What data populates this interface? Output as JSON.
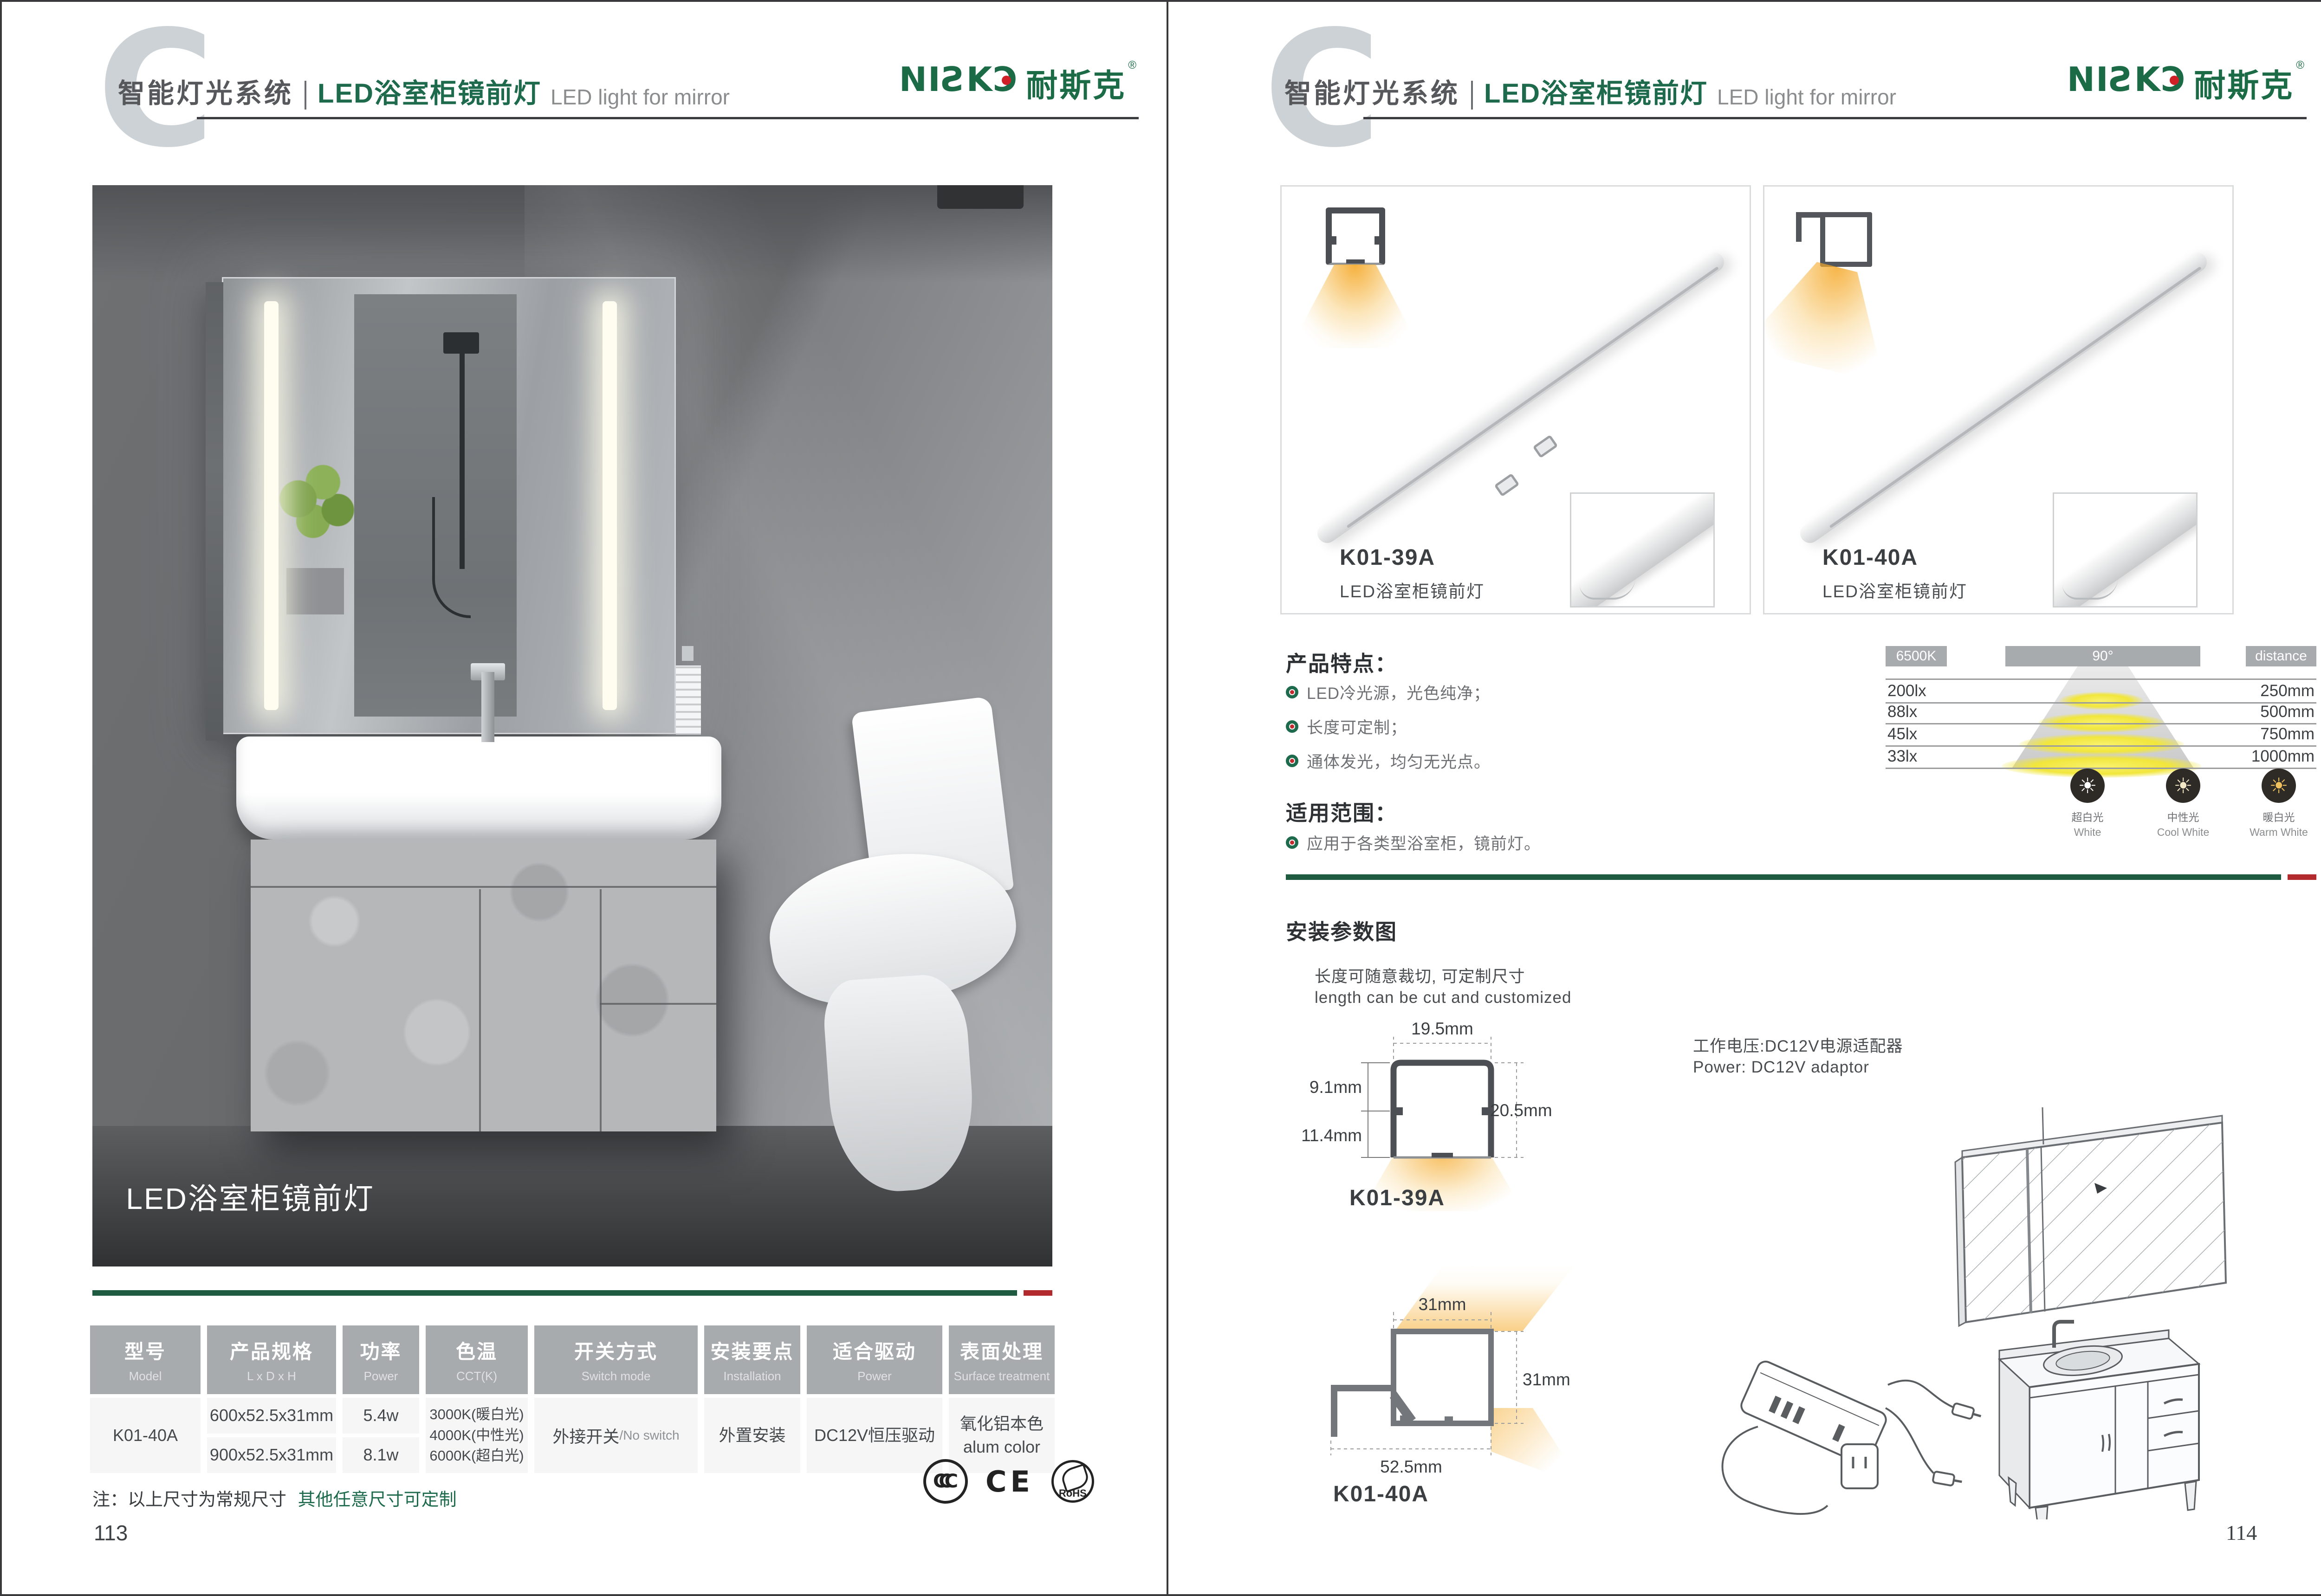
{
  "brand": {
    "latin": "NIƧKƆ",
    "cjk": "耐斯克",
    "reg": "®"
  },
  "header": {
    "watermark": "C",
    "section_zh": "智能灯光系统",
    "title_zh": "LED浴室柜镜前灯",
    "title_en": "LED light for mirror"
  },
  "left_page": {
    "photo_caption": "LED浴室柜镜前灯",
    "table": {
      "headers": [
        {
          "zh": "型号",
          "en": "Model"
        },
        {
          "zh": "产品规格",
          "en": "L x D x H"
        },
        {
          "zh": "功率",
          "en": "Power"
        },
        {
          "zh": "色温",
          "en": "CCT(K)"
        },
        {
          "zh": "开关方式",
          "en": "Switch mode"
        },
        {
          "zh": "安装要点",
          "en": "Installation"
        },
        {
          "zh": "适合驱动",
          "en": "Power"
        },
        {
          "zh": "表面处理",
          "en": "Surface treatment"
        }
      ],
      "model": "K01-40A",
      "specs": [
        "600x52.5x31mm",
        "900x52.5x31mm"
      ],
      "powers": [
        "5.4w",
        "8.1w"
      ],
      "cct": [
        "3000K(暖白光)",
        "4000K(中性光)",
        "6000K(超白光)"
      ],
      "switch_zh": "外接开关",
      "switch_en": "/No switch",
      "installation": "外置安装",
      "driver": "DC12V恒压驱动",
      "surface_zh": "氧化铝本色",
      "surface_en": "alum color"
    },
    "note_black": "注：以上尺寸为常规尺寸",
    "note_green": "其他任意尺寸可定制",
    "certs": {
      "ccc": "CCC",
      "ce": "CE",
      "rohs": "RoHS"
    },
    "page_number": "113"
  },
  "right_page": {
    "products": [
      {
        "model": "K01-39A",
        "name": "LED浴室柜镜前灯"
      },
      {
        "model": "K01-40A",
        "name": "LED浴室柜镜前灯"
      }
    ],
    "features": {
      "title": "产品特点：",
      "items": [
        "LED冷光源，光色纯净；",
        "长度可定制；",
        "通体发光，均匀无光点。"
      ]
    },
    "photometric": {
      "cct": "6500K",
      "angle": "90°",
      "distance_label": "distance",
      "rows": [
        {
          "lux": "200lx",
          "mm": "250mm"
        },
        {
          "lux": "88lx",
          "mm": "500mm"
        },
        {
          "lux": "45lx",
          "mm": "750mm"
        },
        {
          "lux": "33lx",
          "mm": "1000mm"
        }
      ]
    },
    "color_temps": [
      {
        "zh": "超白光",
        "en": "White"
      },
      {
        "zh": "中性光",
        "en": "Cool White"
      },
      {
        "zh": "暖白光",
        "en": "Warm White"
      }
    ],
    "scope": {
      "title": "适用范围：",
      "items": [
        "应用于各类型浴室柜，镜前灯。"
      ]
    },
    "install": {
      "title": "安装参数图",
      "cut_zh": "长度可随意裁切, 可定制尺寸",
      "cut_en": "length can be cut and customized",
      "power_zh": "工作电压:DC12V电源适配器",
      "power_en": "Power: DC12V adaptor",
      "k39": {
        "model": "K01-39A",
        "top": "19.5mm",
        "left_upper": "9.1mm",
        "left_lower": "11.4mm",
        "right": "20.5mm"
      },
      "k40": {
        "model": "K01-40A",
        "top": "31mm",
        "right": "31mm",
        "bottom": "52.5mm"
      }
    },
    "page_number": "114"
  },
  "icons": {
    "sun": "☀"
  },
  "colors": {
    "brand_green": "#1d6b4c",
    "divider_green": "#1e5b41",
    "divider_red": "#b22a2e",
    "table_header_gray": "#a8abae",
    "glow_orange": "#f4a31c",
    "cone_yellow": "#f1e63c"
  }
}
